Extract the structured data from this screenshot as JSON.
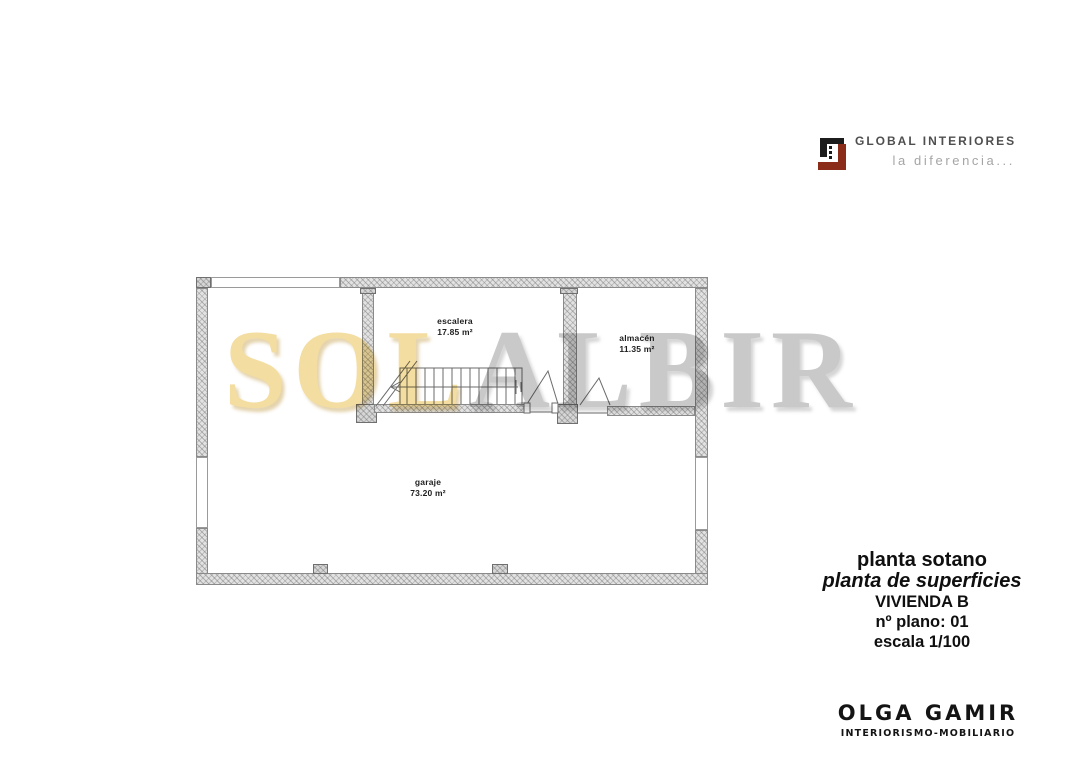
{
  "logo": {
    "brand": "GLOBAL INTERIORES",
    "tagline": "la diferencia...",
    "icon": "global-interiores-logo-icon"
  },
  "watermark": {
    "left": "SOL",
    "right": "ALBIR"
  },
  "plan": {
    "rooms": [
      {
        "name": "escalera",
        "area": "17.85 m²"
      },
      {
        "name": "almacén",
        "area": "11.35 m²"
      },
      {
        "name": "garaje",
        "area": "73.20 m²"
      }
    ]
  },
  "title_block": {
    "plan_name": "planta sotano",
    "plan_type": "planta de superficies",
    "dwelling": "VIVIENDA B",
    "sheet_number": "nº plano: 01",
    "scale": "escala 1/100"
  },
  "author_block": {
    "name": "OLGA GAMIR",
    "subtitle": "INTERIORISMO-MOBILIARIO"
  },
  "colors": {
    "watermark_sol": "#f3dda1",
    "watermark_albir": "#c9c9c9",
    "logo_maroon": "#8a2c17",
    "logo_black": "#1c1c1c",
    "wall_fill": "#e2e2e2"
  }
}
